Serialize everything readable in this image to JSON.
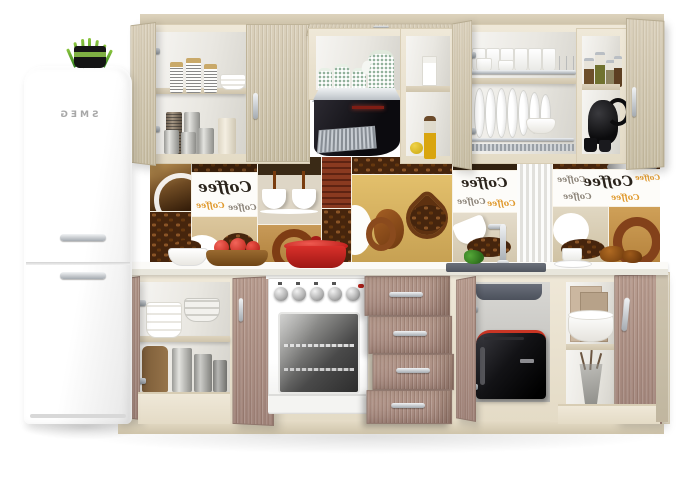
{
  "scene": {
    "type": "product-render",
    "subject": "modular kitchen set with retro fridge and coffee-print backsplash",
    "background_color": "#ffffff"
  },
  "fridge": {
    "brand": "SMEG",
    "logo_mirrored": true,
    "body_color": "#fbfbfb",
    "handle_color": "#b9bec4",
    "plant": {
      "pot_color": "#1a1a1a",
      "band_color": "#7fb043",
      "grass_color": "#4f9e2d"
    }
  },
  "backsplash": {
    "label": "Coffee",
    "label_mirrored": true,
    "label_colors": {
      "primary": "#2b241c",
      "orange": "#e09a2f",
      "gray": "#8d857a"
    },
    "tile_theme": "coffee collage"
  },
  "cabinets": {
    "carcass_color": "#ebe3d1",
    "upper_door_wood": "#d2c7af",
    "base_door_wood": "#b1958a",
    "plinth_color": "#e6ddc8",
    "handle_color": "#c6cbcf"
  },
  "countertop": {
    "color": "#f6f5f0"
  },
  "appliances": {
    "hood_color": "#16151a",
    "stove": {
      "body_color": "#ffffff",
      "knobs": 5,
      "pot_color": "#cf2a28"
    },
    "toaster": {
      "body_color": "#141417",
      "accent_color": "#c93524"
    },
    "sink": {
      "basin_color": "#5c616b",
      "faucet_color": "#aab0b6"
    }
  }
}
